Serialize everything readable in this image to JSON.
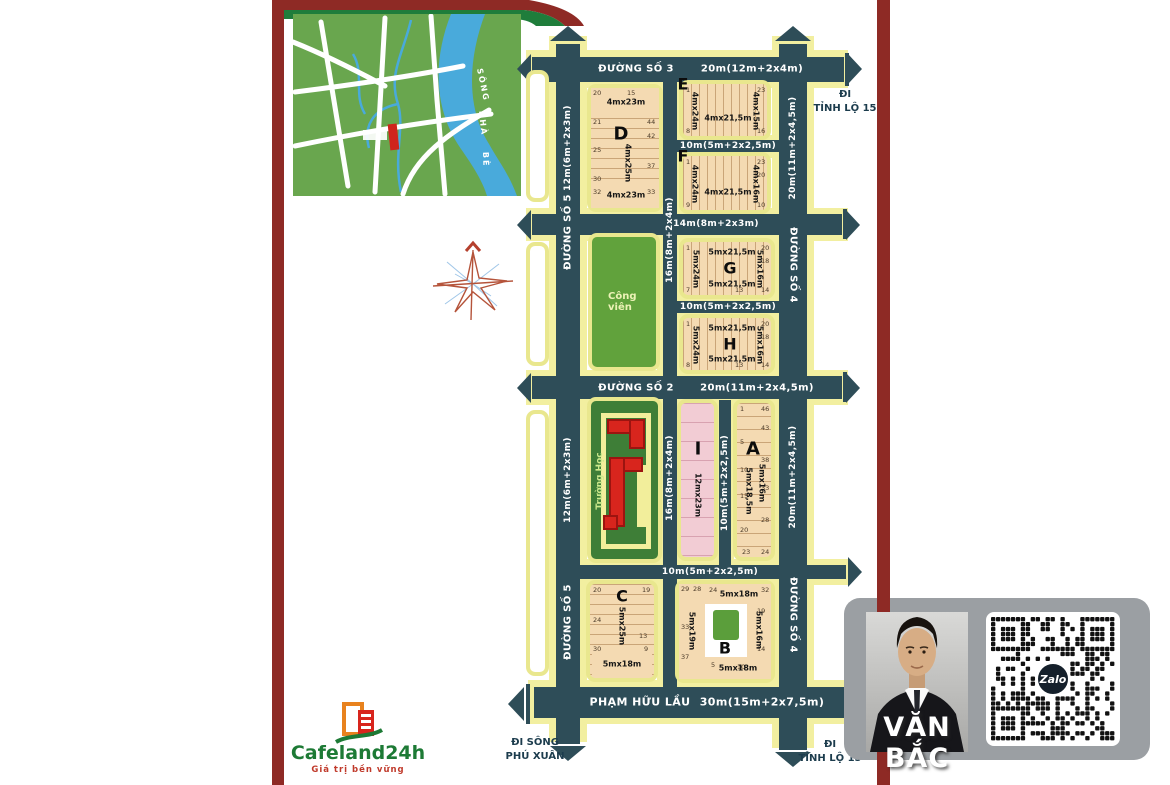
{
  "palette": {
    "road": "#2e4d58",
    "road_edge": "#f2efa0",
    "block_tan": "#f4dab2",
    "block_pink": "#f2ccd4",
    "park_green": "#61a23c",
    "school_green": "#3e7e37",
    "maroon": "#8e2a25",
    "brand_green": "#1d7a35",
    "brand_red": "#c03a2b",
    "navy_text": "#1c3c4d",
    "river_blue": "#49aadb",
    "map_green": "#69a64e",
    "card_gray": "#9b9fa3",
    "building_red": "#d8251d"
  },
  "inset_map": {
    "river_word_1": "SÔNG",
    "river_word_2": "NHÀ",
    "river_word_3": "BÈ"
  },
  "logo": {
    "name": "Cafeland24h",
    "tagline": "Giá trị bền vững"
  },
  "agent": {
    "name": "VĂN BẮC",
    "zalo": "Zalo"
  },
  "exits": {
    "top_right_1": "ĐI",
    "top_right_2": "TỈNH LỘ 15",
    "bottom_left_1": "ĐI SÔNG",
    "bottom_left_2": "PHÚ XUÂN",
    "bottom_right_1": "ĐI",
    "bottom_right_2": "TỈNH LỘ 15"
  },
  "roads": {
    "r1_name": "ĐƯỜNG SỐ 3",
    "r1_dim": "20m(12m+2x4m)",
    "r2_dim": "10m(5m+2x2,5m)",
    "r3_dim": "14m(8m+2x3m)",
    "r4_dim": "10m(5m+2x2,5m)",
    "r5_name": "ĐƯỜNG SỐ 2",
    "r5_dim": "20m(11m+2x4,5m)",
    "r6_dim": "10m(5m+2x2,5m)",
    "r7_name": "PHẠM HỮU LẦU",
    "r7_dim": "30m(15m+2x7,5m)",
    "v1_name": "ĐƯỜNG SỐ 5",
    "v1_dim": "12m(6m+2x3m)",
    "v2_dim": "16m(8m+2x4m)",
    "v3_name": "ĐƯỜNG SỐ 4",
    "v3_dim": "20m(11m+2x4,5m)",
    "v4_dim": "10m(5m+2x2,5m)"
  },
  "areas": {
    "park": "Công viên",
    "school": "Trường Học"
  },
  "blocks": {
    "D": {
      "label": "D",
      "top": "4mx23m",
      "mid": "4mx25m",
      "bottom": "4mx23m",
      "lots": [
        "20",
        "15",
        "21",
        "44",
        "42",
        "25",
        "37",
        "30",
        "32",
        "33"
      ]
    },
    "E": {
      "label": "E",
      "left": "4mx24m",
      "center": "4mx21,5m",
      "right": "4mx15m",
      "lots": [
        "1",
        "23",
        "8",
        "16"
      ]
    },
    "F": {
      "label": "F",
      "left": "4mx24m",
      "center": "4mx21,5m",
      "right": "4mx16m",
      "lots": [
        "1",
        "23",
        "20",
        "9",
        "10"
      ]
    },
    "G": {
      "label": "G",
      "left": "5mx24m",
      "top": "5mx21,5m",
      "bottom": "5mx21,5m",
      "right": "5mx16m",
      "lots": [
        "1",
        "20",
        "18",
        "7",
        "13",
        "14"
      ]
    },
    "H": {
      "label": "H",
      "left": "5mx24m",
      "top": "5mx21,5m",
      "bottom": "5mx21,5m",
      "right": "5mx16m",
      "lots": [
        "1",
        "20",
        "18",
        "8",
        "13",
        "14"
      ]
    },
    "I": {
      "label": "I",
      "dim": "12mx23m"
    },
    "A": {
      "label": "A",
      "dim1": "5mx18,5m",
      "dim2": "5mx16m",
      "lots": [
        "1",
        "46",
        "43",
        "5",
        "10",
        "38",
        "33",
        "15",
        "28",
        "20",
        "23",
        "24"
      ]
    },
    "C": {
      "label": "C",
      "mid": "5mx25m",
      "bottom": "5mx18m",
      "lots": [
        "20",
        "19",
        "24",
        "13",
        "30",
        "9"
      ]
    },
    "B": {
      "label": "B",
      "left": "5mx19m",
      "top": "5mx18m",
      "right": "5mx16m",
      "bottom": "5mx18m",
      "lots": [
        "29",
        "28",
        "33",
        "37",
        "24",
        "32",
        "19",
        "14",
        "5",
        "10"
      ]
    }
  }
}
